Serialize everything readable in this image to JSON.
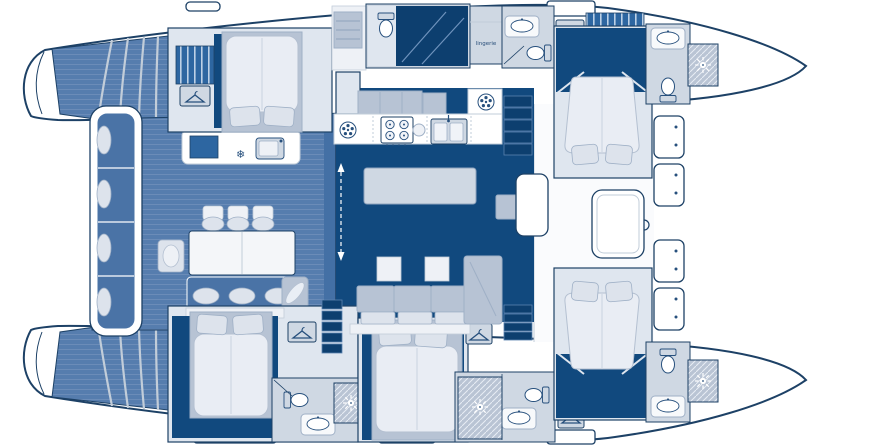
{
  "labels": {
    "lingerie": "lingerie"
  },
  "icons": {
    "snowflake": "❄",
    "hanger": "hanger-icon",
    "shower_sun": "shower-sun-icon",
    "vent_fan": "vent-fan-icon"
  },
  "colors": {
    "deck": "#567dae",
    "deck_line": "#6b8cb8",
    "navy_floor": "#11497e",
    "navy_deep": "#0d3f6f",
    "outline": "#1d4166",
    "light": "#dfe6ef",
    "lighter": "#eef1f6",
    "furniture": "#cfd8e3",
    "furniture_dark": "#b7c3d4",
    "furniture_stroke": "#9fb0c6",
    "accent_blue": "#2d66a1",
    "cushion": "#4a73a6",
    "hatch_bg": "#b9c4d4",
    "pale_stroke": "#c2cdd9",
    "duvet": "#e9edf4",
    "duvet_stroke": "#b4c0d1",
    "icon_navy": "#27507d",
    "background": "#ffffff"
  }
}
